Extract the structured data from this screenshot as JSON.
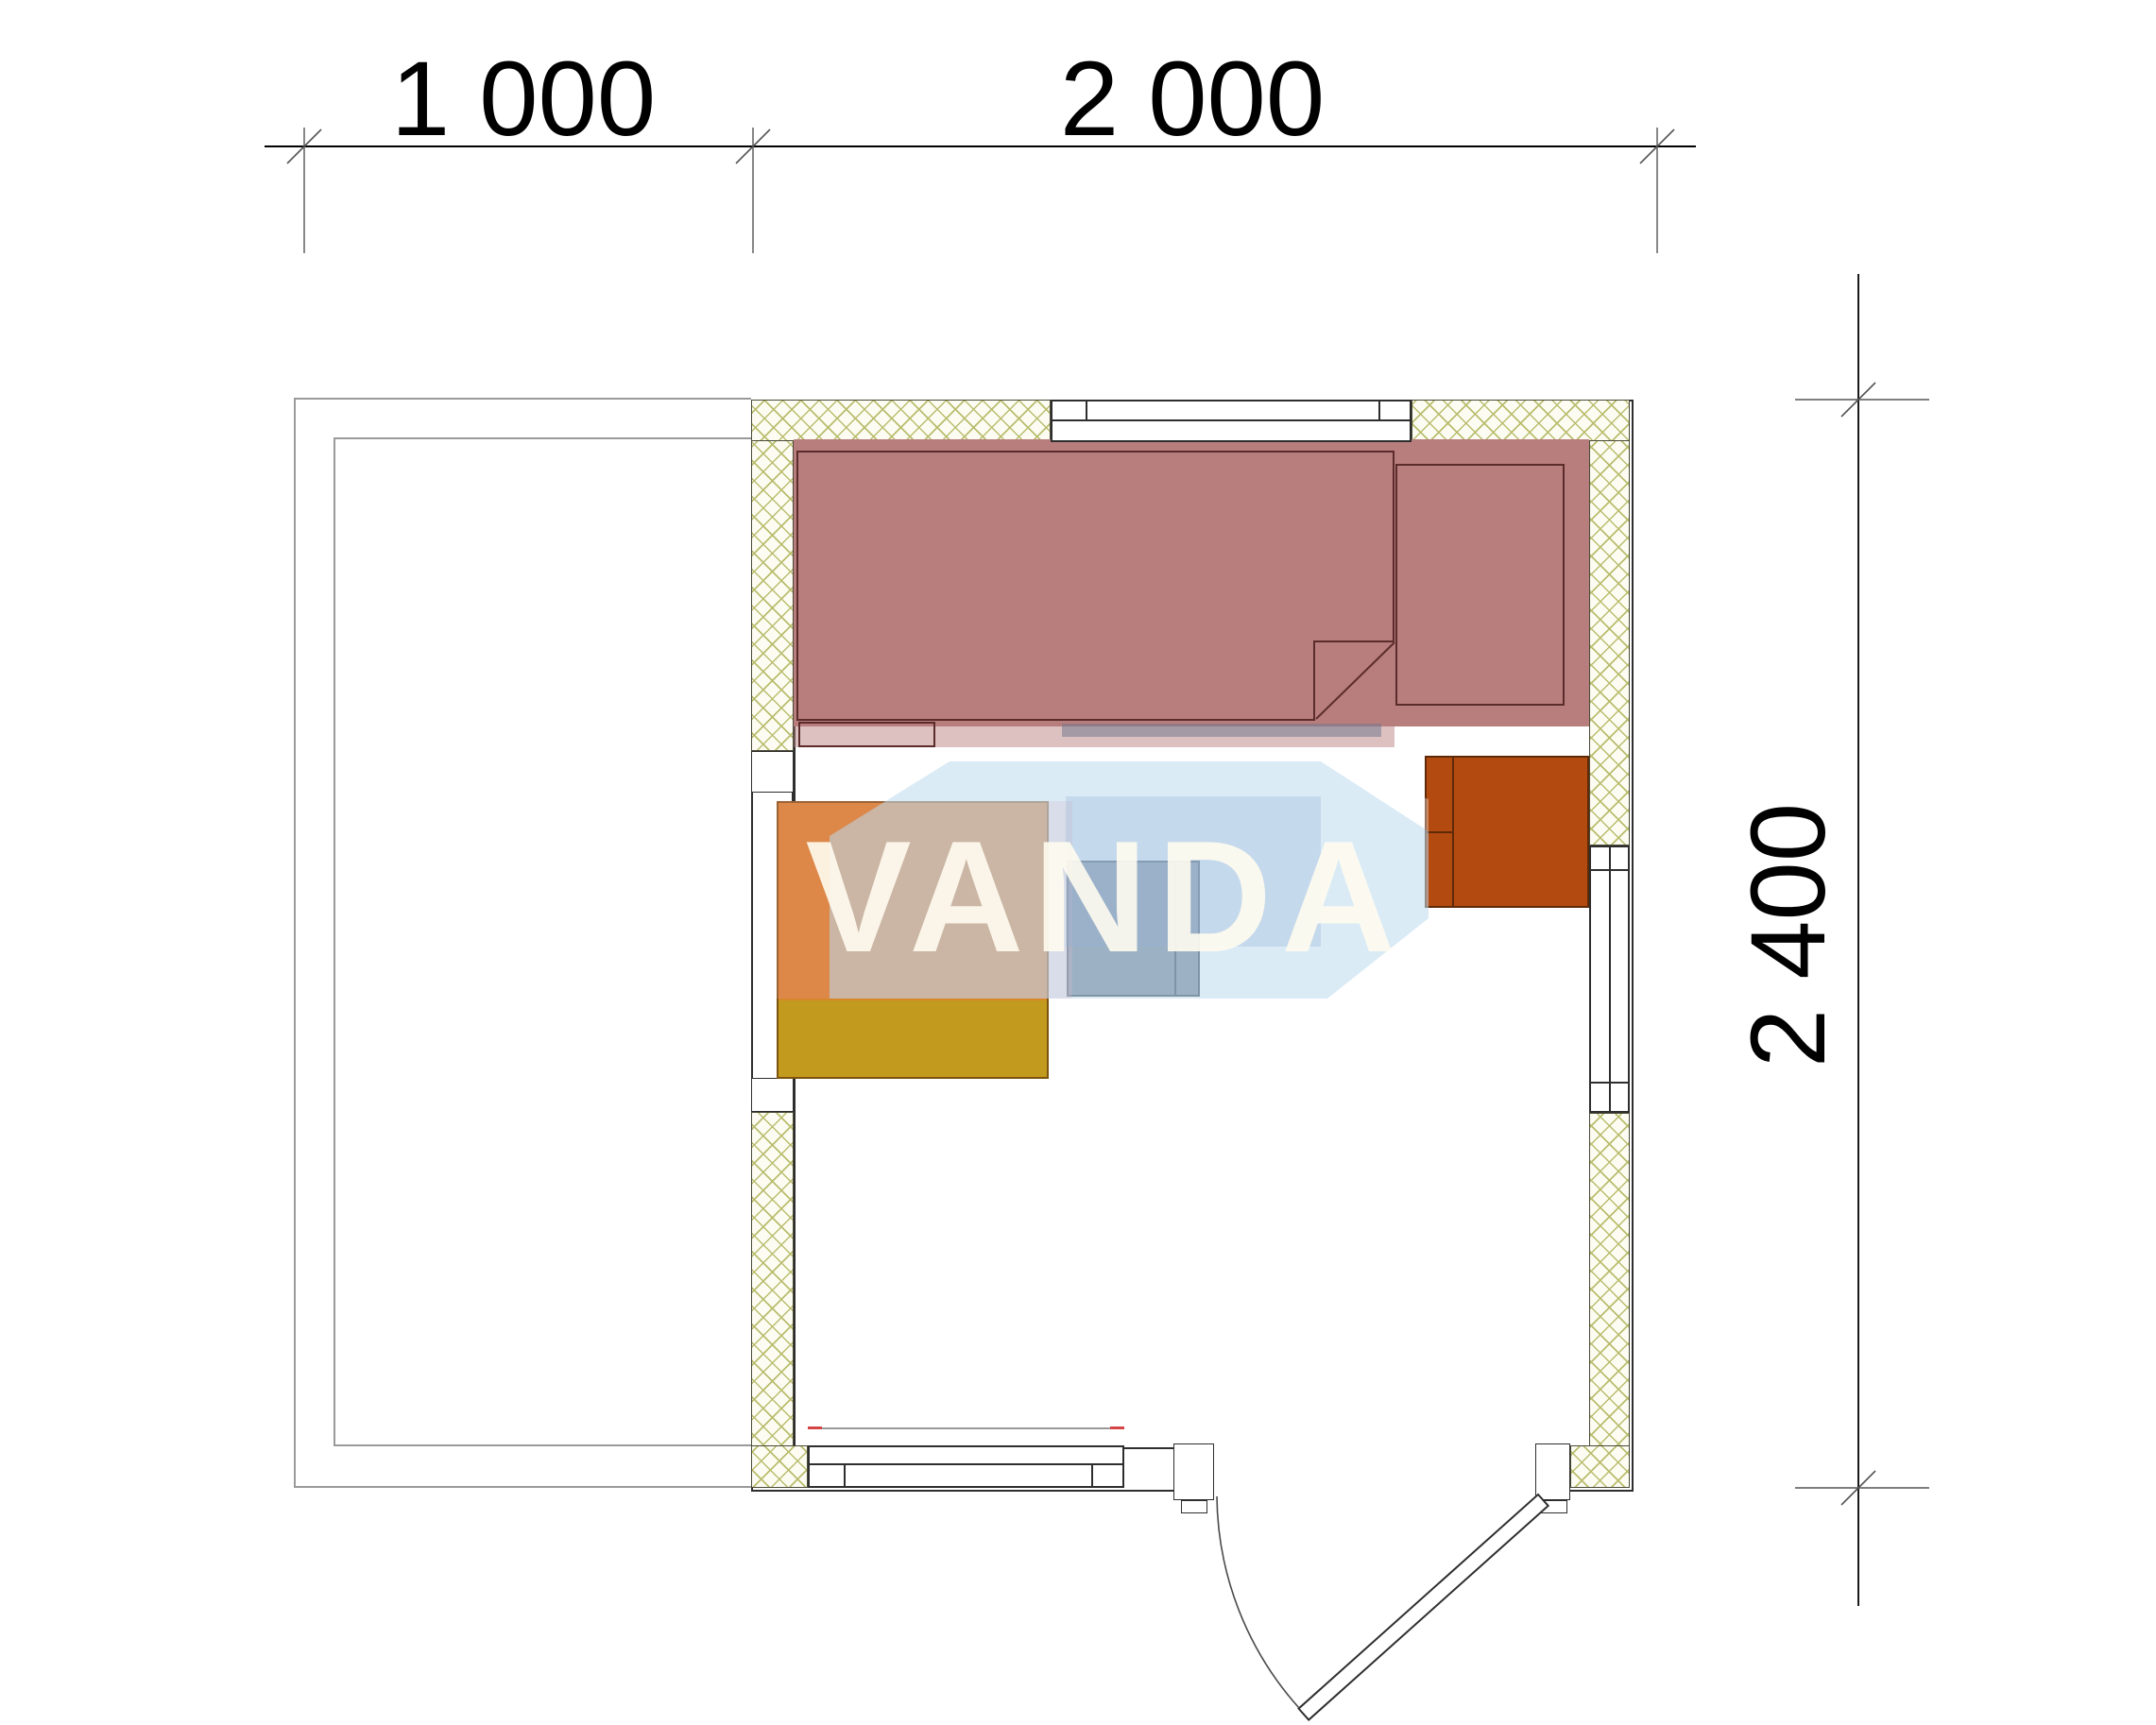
{
  "drawing": {
    "type": "architectural-floor-plan",
    "building_width_label": "2 000",
    "terrace_width_label": "1 000",
    "building_depth_label": "2 400"
  },
  "dimensions": {
    "top": [
      {
        "label": "1 000"
      },
      {
        "label": "2 000"
      }
    ],
    "right": {
      "label": "2 400"
    }
  },
  "watermark": {
    "text": "VANDA"
  },
  "colors": {
    "background": "#ffffff",
    "wall_line": "#2e2e2e",
    "terrace_line": "#9a9a9a",
    "hatch_line": "#b9bd6e",
    "bench_fill": "#b87e7e",
    "bench_outline": "#5c2b2b",
    "table_orange": "#d6872a",
    "table_gold": "#c29a1e",
    "stool_gray": "#586778",
    "heater_orange": "#b34b10",
    "watermark_blue": "#bbdbef",
    "watermark_pink": "#f28b9a",
    "dimension_text": "#000000",
    "window_sill_red": "#d64545"
  }
}
